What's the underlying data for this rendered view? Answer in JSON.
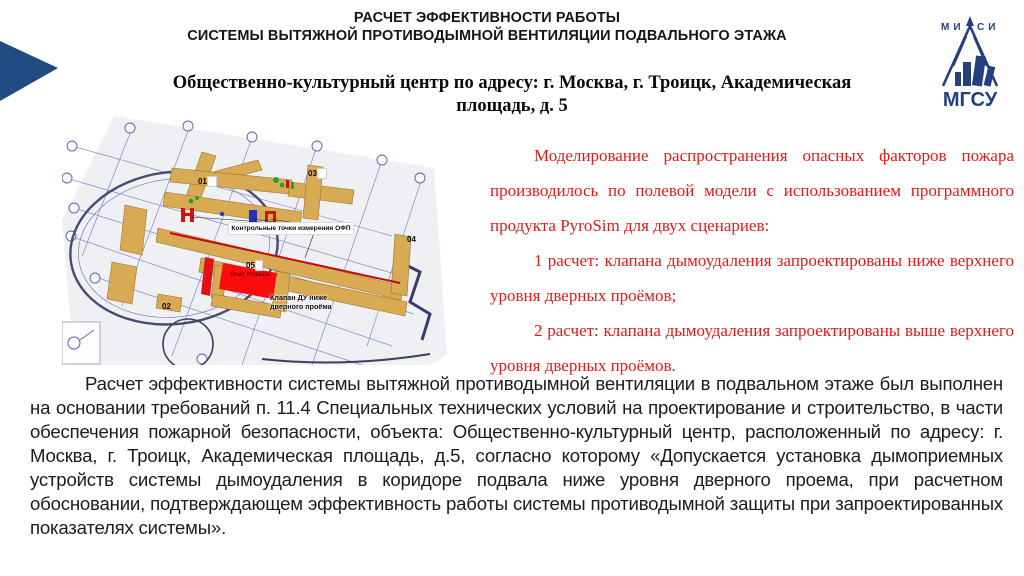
{
  "slide": {
    "title_line1": "РАСЧЕТ ЭФФЕКТИВНОСТИ РАБОТЫ",
    "title_line2": "СИСТЕМЫ ВЫТЯЖНОЙ ПРОТИВОДЫМНОЙ ВЕНТИЛЯЦИИ ПОДВАЛЬНОГО ЭТАЖА",
    "subtitle": "Общественно-культурный центр по адресу: г. Москва, г. Троицк, Академическая площадь, д. 5"
  },
  "logo": {
    "top_text": "МИСИ",
    "bottom_text": "МГСУ",
    "color": "#24407e"
  },
  "accent_color": "#1e4c82",
  "diagram": {
    "labels": {
      "o1": "01",
      "o2": "02",
      "o3": "03",
      "o4": "04",
      "o5": "05",
      "control_points": "Контрольные точки измерения ОФП",
      "fire_source": "Очаг пожара",
      "valve_line1": "Клапан ДУ ниже",
      "valve_line2": "дверного проёма"
    },
    "colors": {
      "wall": "#d9aa54",
      "fire_zone": "#fb0d0d",
      "blueprint_line": "#7878bc",
      "route_line": "#c40b0b"
    }
  },
  "red_text": {
    "color": "#e11a1a",
    "paragraph": "Моделирование распространения опасных факторов пожара производилось по полевой модели с использованием программного продукта PyroSim для двух сценариев:",
    "item1": "1 расчет: клапана дымоудаления запроектированы ниже верхнего уровня дверных проёмов;",
    "item2": "2 расчет: клапана дымоудаления запроектированы выше верхнего уровня дверных проёмов."
  },
  "bottom_text": {
    "paragraph": "Расчет эффективности системы вытяжной противодымной вентиляции в подвальном этаже был выполнен на основании требований п. 11.4 Специальных технических условий на проектирование и строительство, в части обеспечения пожарной безопасности, объекта: Общественно-культурный центр, расположенный по адресу: г. Москва, г. Троицк, Академическая площадь, д.5, согласно которому «Допускается установка дымоприемных устройств системы дымоудаления в коридоре подвала ниже уровня дверного проема, при расчетном обосновании, подтверждающем  эффективность работы системы противодымной защиты при запроектированных показателях системы»."
  }
}
